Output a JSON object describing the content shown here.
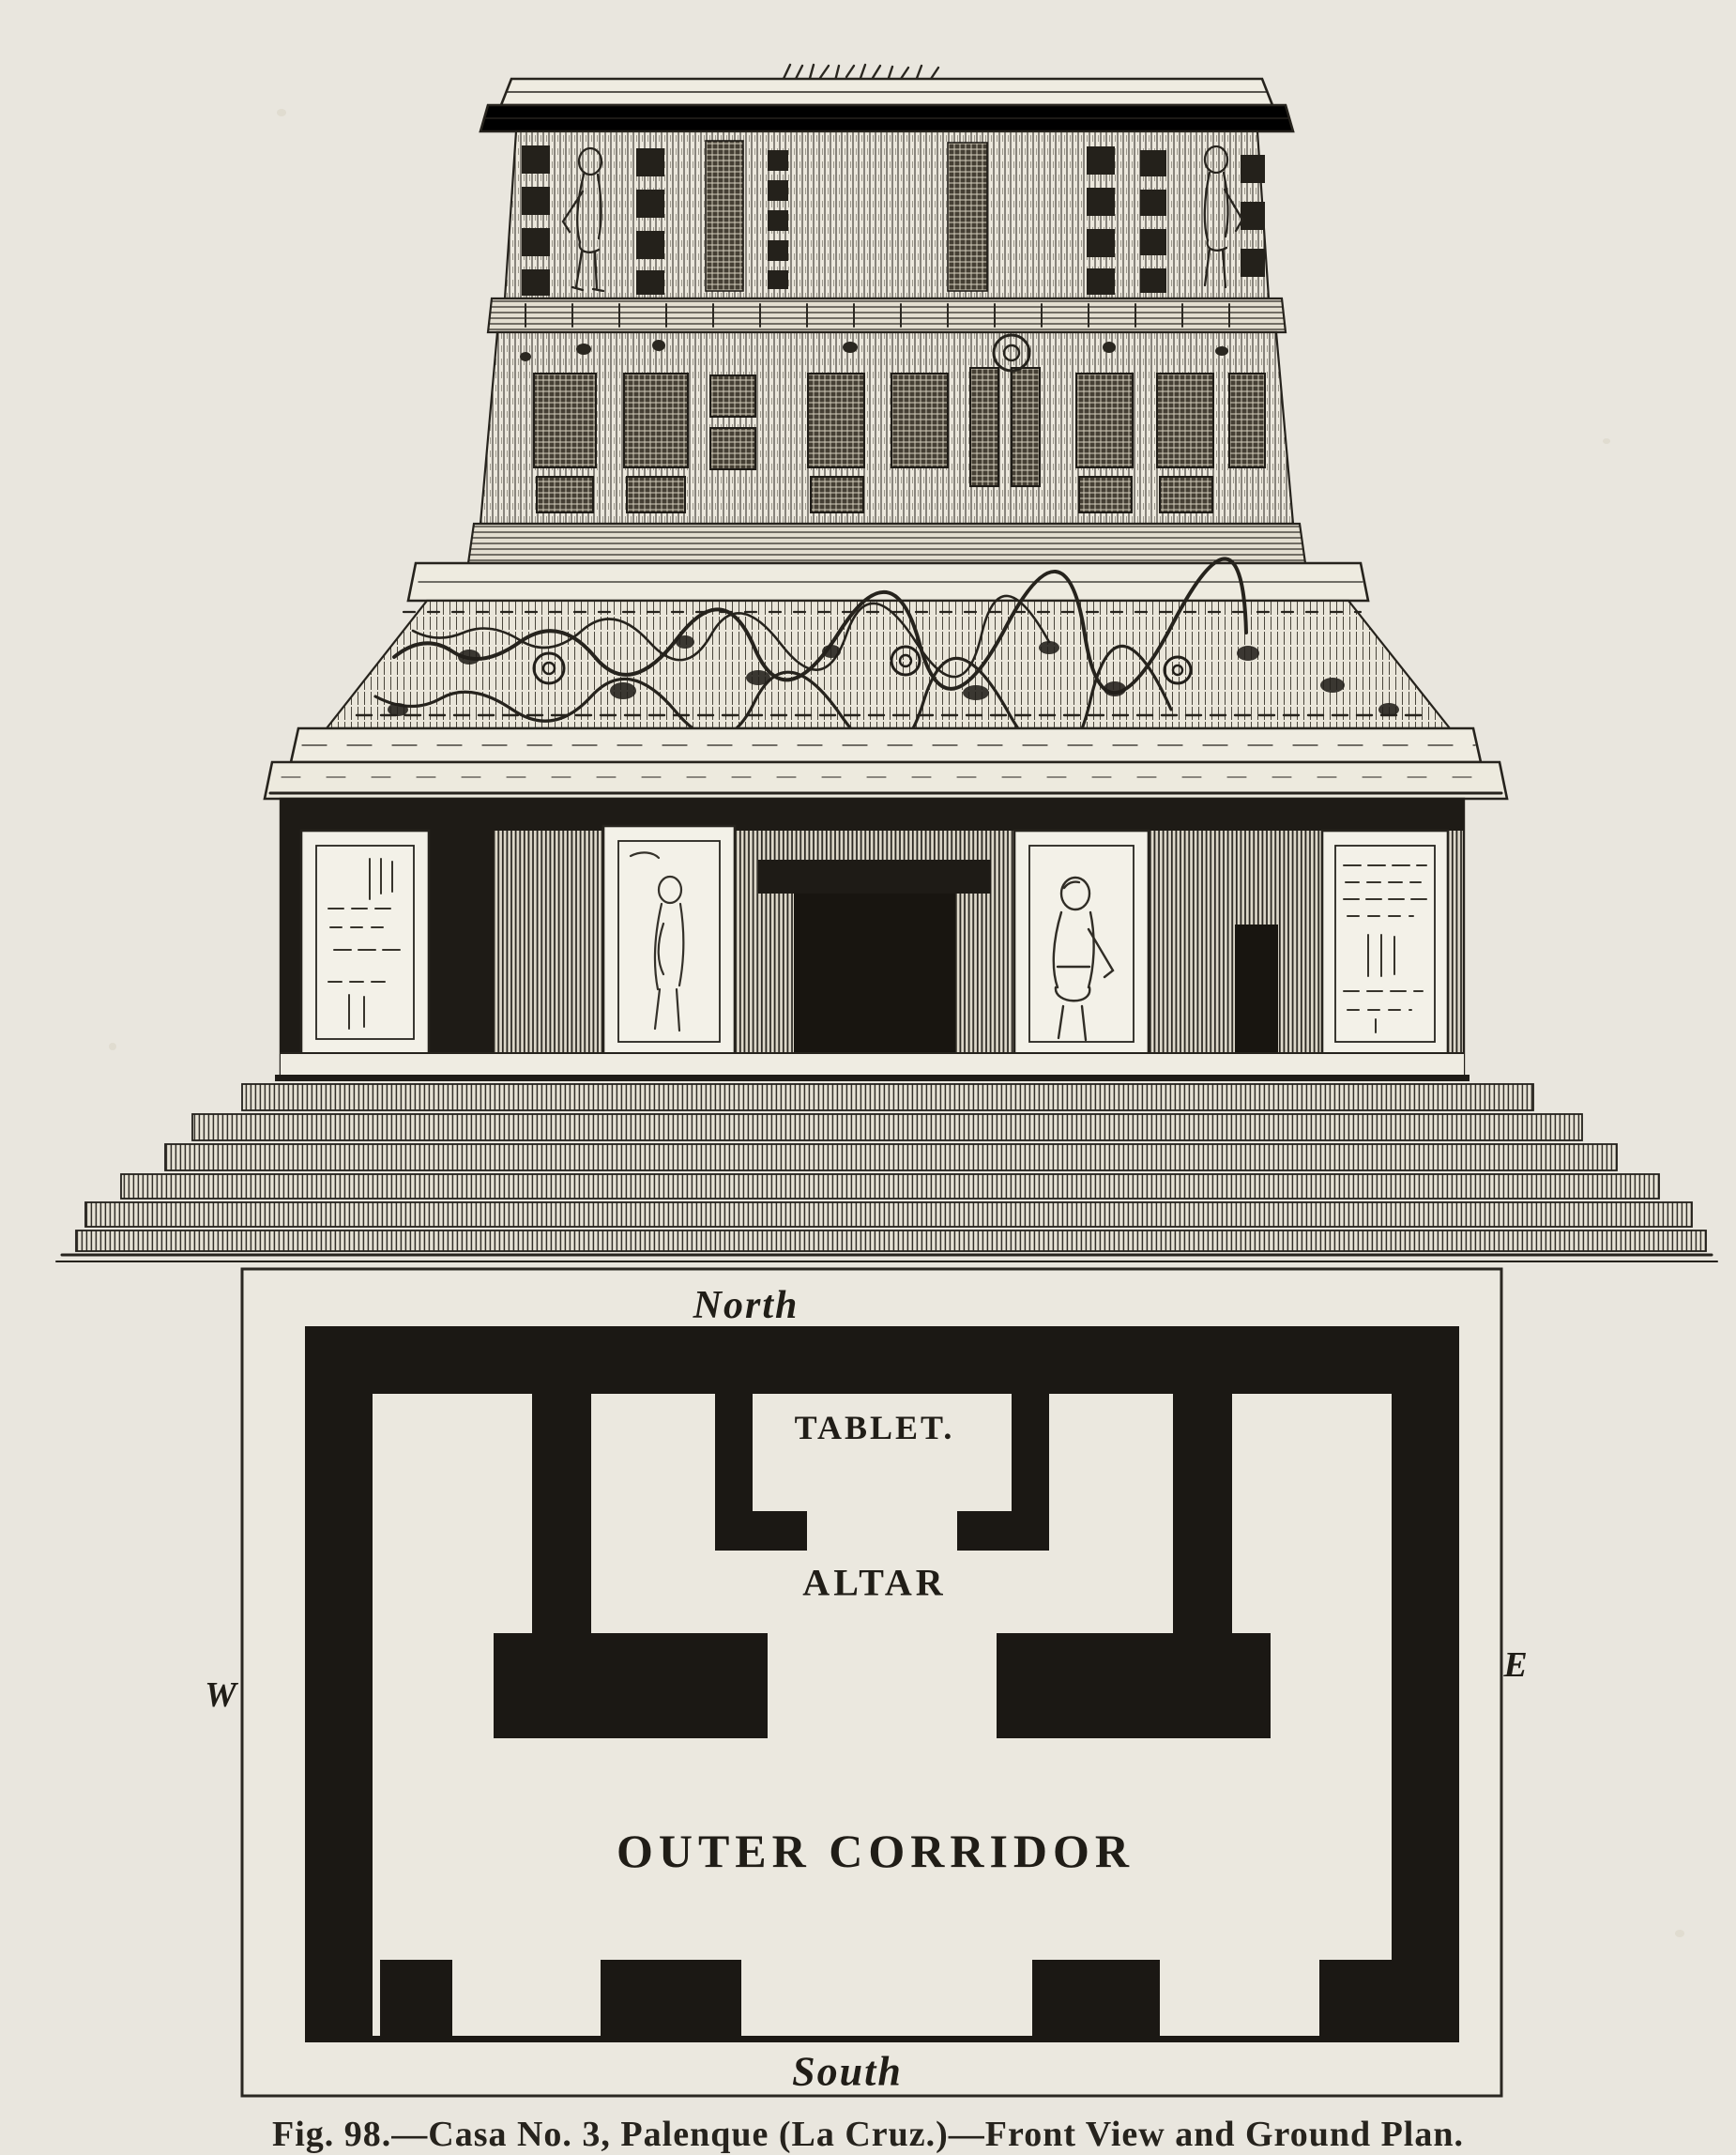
{
  "plate": {
    "caption": "Fig. 98.—Casa No. 3, Palenque (La Cruz.)—Front View and Ground Plan.",
    "colors": {
      "paper": "#e9e6de",
      "ink": "#26231d",
      "wall_black": "#1b1814"
    },
    "ground_plan": {
      "compass": {
        "north": "North",
        "south": "South",
        "west": "W",
        "east": "E"
      },
      "rooms": {
        "tablet": "TABLET.",
        "altar": "ALTAR",
        "outer_corridor": "OUTER CORRIDOR"
      }
    }
  }
}
